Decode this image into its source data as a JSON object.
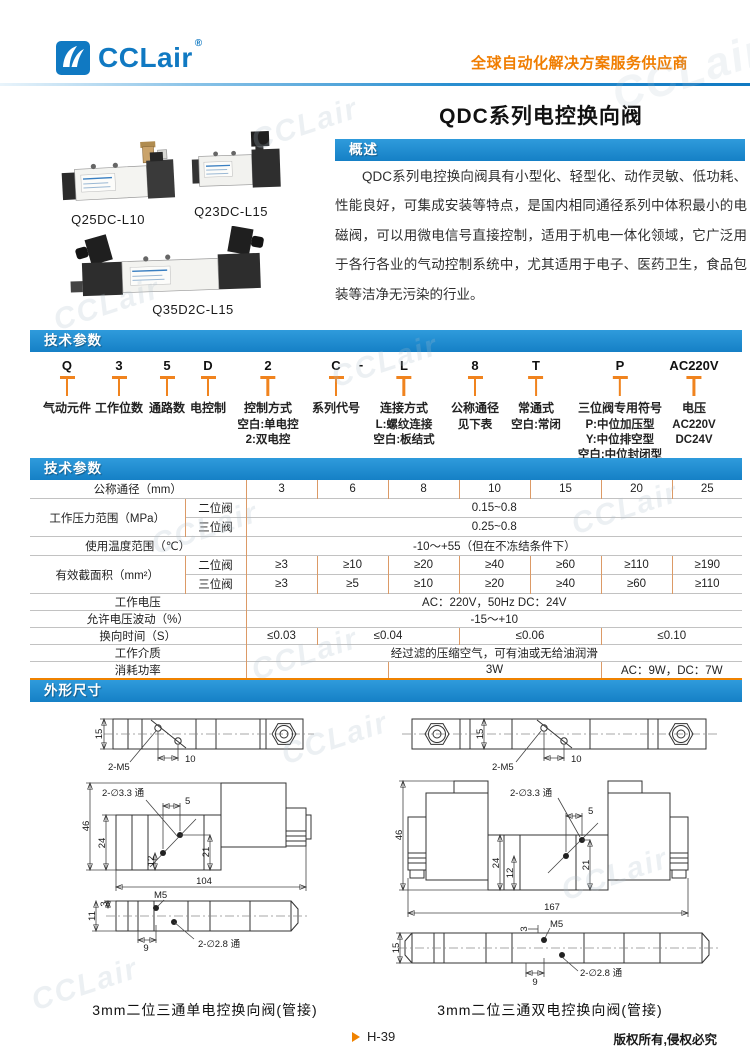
{
  "brand": {
    "logo_text": "CCLair",
    "registered": "®",
    "tagline": "全球自动化解决方案服务供应商"
  },
  "page": {
    "title": "QDC系列电控换向阀",
    "watermark": "CCLair",
    "page_number": "H-39",
    "copyright": "版权所有,侵权必究"
  },
  "sections": {
    "overview": "概述",
    "tech_params": "技术参数",
    "tech_table": "技术参数",
    "dimensions": "外形尺寸"
  },
  "products": {
    "p1": "Q25DC-L10",
    "p2": "Q23DC-L15",
    "p3": "Q35D2C-L15"
  },
  "overview": {
    "text": "QDC系列电控换向阀具有小型化、轻型化、动作灵敏、低功耗、性能良好，可集成安装等特点，是国内相同通径系列中体积最小的电磁阀，可以用微电信号直接控制，适用于机电一体化领域，它广泛用于各行各业的气动控制系统中，尤其适用于电子、医药卫生，食品包装等洁净无污染的行业。"
  },
  "model_code": {
    "items": [
      {
        "code": "Q",
        "label": "气动元件"
      },
      {
        "code": "3",
        "label": "工作位数"
      },
      {
        "code": "5",
        "label": "通路数"
      },
      {
        "code": "D",
        "label": "电控制"
      },
      {
        "code": "2",
        "label": "控制方式",
        "sub1": "空白:单电控",
        "sub2": "2:双电控"
      },
      {
        "code": "C",
        "label": "系列代号"
      },
      {
        "code": "-"
      },
      {
        "code": "L",
        "label": "连接方式",
        "sub1": "L:螺纹连接",
        "sub2": "空白:板结式"
      },
      {
        "code": "8",
        "label": "公称通径",
        "sub1": "见下表"
      },
      {
        "code": "T",
        "label": "常通式",
        "sub1": "空白:常闭"
      },
      {
        "code": "P",
        "label": "三位阀专用符号",
        "sub1": "P:中位加压型",
        "sub2": "Y:中位排空型",
        "sub3": "空白:中位封闭型"
      },
      {
        "code": "AC220V",
        "label": "电压",
        "sub1": "AC220V",
        "sub2": "DC24V"
      }
    ]
  },
  "spec_table": {
    "diameter_label": "公称通径（mm）",
    "diameters": [
      "3",
      "6",
      "8",
      "10",
      "15",
      "20",
      "25"
    ],
    "pressure_label": "工作压力范围（MPa）",
    "two_position": "二位阀",
    "three_position": "三位阀",
    "pressure_two": "0.15~0.8",
    "pressure_three": "0.25~0.8",
    "temperature_label": "使用温度范围（℃）",
    "temperature_value": "-10～+55（但在不冻结条件下）",
    "area_label": "有效截面积（mm²）",
    "area_two": [
      "≥3",
      "≥10",
      "≥20",
      "≥40",
      "≥60",
      "≥110",
      "≥190"
    ],
    "area_three": [
      "≥3",
      "≥5",
      "≥10",
      "≥20",
      "≥40",
      "≥60",
      "≥110"
    ],
    "voltage_label": "工作电压",
    "voltage_value": "AC：220V，50Hz DC：24V",
    "fluctuation_label": "允许电压波动（%）",
    "fluctuation_value": "-15～+10",
    "switch_time_label": "换向时间（S）",
    "switch_times": [
      "≤0.03",
      "≤0.04",
      "≤0.06",
      "≤0.10"
    ],
    "medium_label": "工作介质",
    "medium_value": "经过滤的压缩空气，可有油或无给油润滑",
    "power_label": "消耗功率",
    "power_blank": "",
    "power_mid": "3W",
    "power_right": "AC：9W，DC：7W"
  },
  "drawings": {
    "left": {
      "caption": "3mm二位三通单电控换向阀(管接)",
      "d15": "15",
      "d2m5": "2-M5",
      "d10": "10",
      "dholes": "2-∅3.3 通",
      "d46": "46",
      "d24": "24",
      "d12": "12",
      "d21": "21",
      "d5": "5",
      "d104": "104",
      "dm5": "M5",
      "d3": "3",
      "d11": "11",
      "d9": "9",
      "dholes2": "2-∅2.8 通"
    },
    "right": {
      "caption": "3mm二位三通双电控换向阀(管接)",
      "d15": "15",
      "d2m5": "2-M5",
      "d10": "10",
      "dholes": "2-∅3.3 通",
      "d46": "46",
      "d24": "24",
      "d12": "12",
      "d21": "21",
      "d5": "5",
      "d167": "167",
      "dm5": "M5",
      "d3": "3",
      "d15b": "15",
      "d9": "9",
      "dholes2": "2-∅2.8 通"
    }
  }
}
